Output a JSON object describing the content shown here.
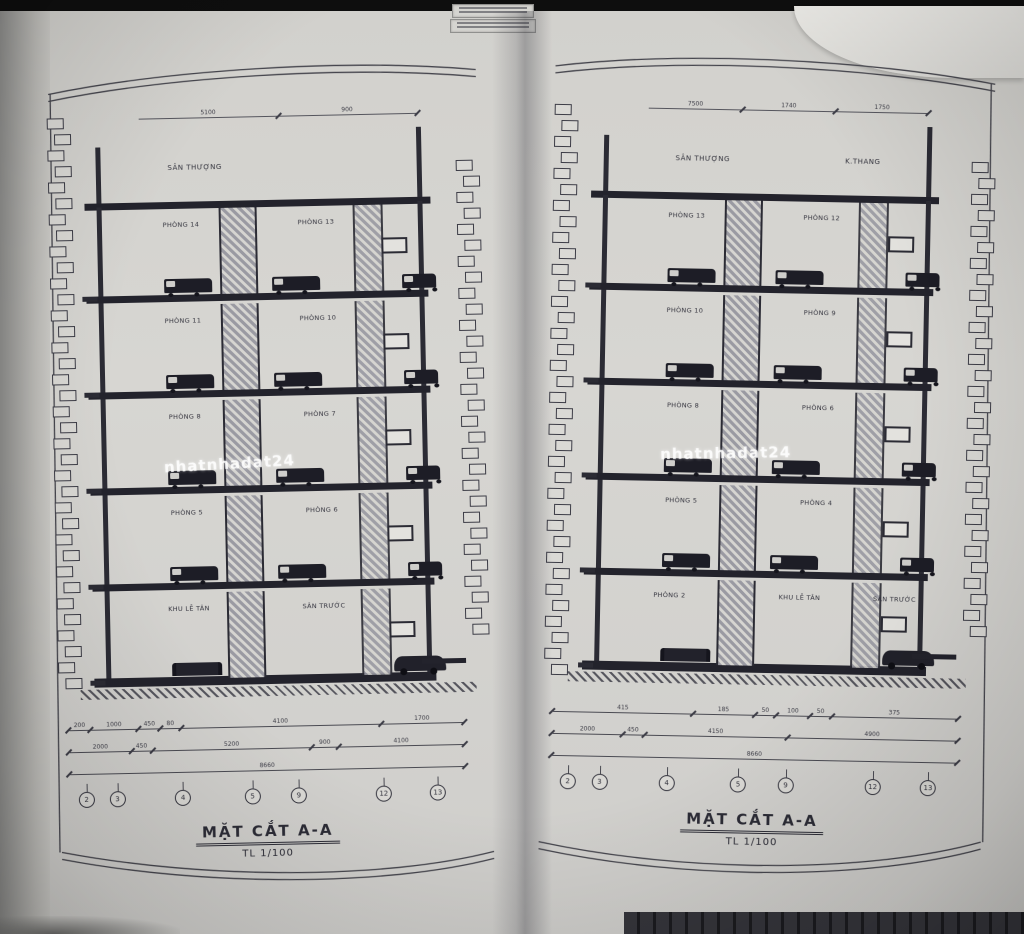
{
  "document": {
    "kind": "architectural section drawings, photographed open booklet",
    "language": "Vietnamese"
  },
  "colors": {
    "paper": "#d4d3cf",
    "ink": "#3c3c46",
    "furniture": "#20202a",
    "title_text": "#2c2c36"
  },
  "pages": [
    {
      "side": "left",
      "title": "MẶT CẮT A-A",
      "scale": "TL 1/100",
      "roof_labels": [
        "SÂN THƯỢNG"
      ],
      "top_dims": [
        "5100",
        "900"
      ],
      "floors": [
        {
          "rooms": [
            "PHÒNG 14",
            "PHÒNG 13"
          ]
        },
        {
          "rooms": [
            "PHÒNG 11",
            "PHÒNG 10"
          ]
        },
        {
          "rooms": [
            "PHÒNG 8",
            "PHÒNG 7"
          ]
        },
        {
          "rooms": [
            "PHÒNG 5",
            "PHÒNG 6"
          ]
        },
        {
          "rooms": [
            "KHU LỄ TÂN",
            "SÂN TRƯỚC"
          ]
        }
      ],
      "dim_rows": [
        [
          "200",
          "1000",
          "450",
          "80",
          "4100",
          "1700"
        ],
        [
          "2000",
          "450",
          "5200",
          "900",
          "4100"
        ],
        [
          "8660"
        ]
      ],
      "grid_bubbles": [
        "2",
        "3",
        "4",
        "5",
        "9",
        "12",
        "13"
      ],
      "watermark": "nhatnhadat24"
    },
    {
      "side": "right",
      "title": "MẶT CẮT A-A",
      "scale": "TL 1/100",
      "roof_labels": [
        "SÂN THƯỢNG",
        "K.THANG"
      ],
      "top_dims": [
        "7500",
        "1740",
        "1750"
      ],
      "floors": [
        {
          "rooms": [
            "PHÒNG 13",
            "PHÒNG 12"
          ]
        },
        {
          "rooms": [
            "PHÒNG 10",
            "PHÒNG 9"
          ]
        },
        {
          "rooms": [
            "PHÒNG 8",
            "PHÒNG 6"
          ]
        },
        {
          "rooms": [
            "PHÒNG 5",
            "PHÒNG 4"
          ]
        },
        {
          "rooms": [
            "PHÒNG 2",
            "KHU LỄ TÂN",
            "SÂN TRƯỚC"
          ]
        }
      ],
      "dim_rows": [
        [
          "415",
          "185",
          "50",
          "100",
          "50",
          "375"
        ],
        [
          "2000",
          "450",
          "4150",
          "4900"
        ],
        [
          "8660"
        ]
      ],
      "grid_bubbles": [
        "2",
        "3",
        "4",
        "5",
        "9",
        "12",
        "13"
      ],
      "watermark": "nhatnhadat24"
    }
  ]
}
